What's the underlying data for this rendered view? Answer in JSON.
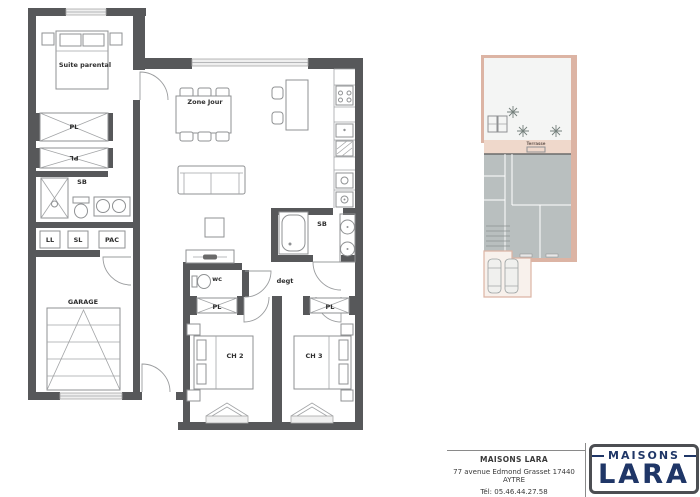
{
  "plan": {
    "rooms": {
      "suite_parental": "Suite parental",
      "pl": "PL",
      "sb": "SB",
      "ll": "LL",
      "sl": "SL",
      "pac": "PAC",
      "garage": "GARAGE",
      "zone_jour": "Zone Jour",
      "wc": "wc",
      "degt": "degt",
      "ch2": "CH 2",
      "ch3": "CH 3"
    }
  },
  "site": {
    "terrasse": "Terrasse"
  },
  "title_block": {
    "company": "MAISONS LARA",
    "address": "77 avenue Edmond Grasset 17440 AYTRE",
    "phone": "Tél: 05.46.44.27.58",
    "logo_top": "MAISONS",
    "logo_main": "LARA"
  },
  "colors": {
    "wall": "#57585a",
    "site_pink": "#dcb4a4",
    "terrasse_fill": "#efd8cb",
    "house_gray": "#b9bfbf",
    "logo_navy": "#1f3667"
  }
}
